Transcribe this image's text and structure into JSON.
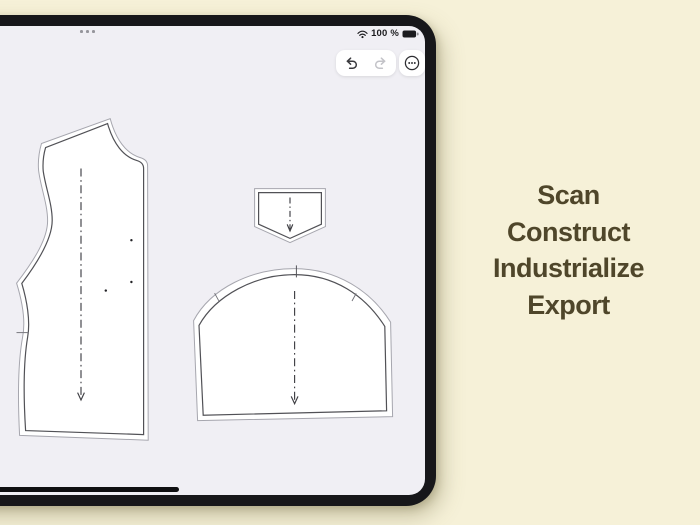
{
  "page": {
    "background_color": "#f6f1d8"
  },
  "headline": {
    "lines": [
      "Scan",
      "Construct",
      "Industrialize",
      "Export"
    ],
    "text_color": "#4f462a"
  },
  "device": {
    "frame_color": "#17171a",
    "screen_color": "#f0eff4",
    "multitask_handle": {
      "icon": "multitask-dots-icon"
    },
    "status_bar": {
      "wifi_icon": "wifi-icon",
      "battery_text": "100 %",
      "battery_icon": "battery-full-icon"
    },
    "toolbar": {
      "undo_icon": "undo-arrow-icon",
      "undo_enabled": true,
      "redo_icon": "redo-arrow-icon",
      "redo_enabled": false,
      "more_icon": "ellipsis-circle-icon"
    },
    "home_indicator": true
  },
  "canvas": {
    "pieces": [
      {
        "name": "bodice-pattern-piece",
        "markings": [
          "grainline-arrow",
          "dart-point-dots",
          "waist-notch"
        ]
      },
      {
        "name": "pocket-pattern-piece",
        "markings": [
          "grainline-arrow"
        ]
      },
      {
        "name": "sleeve-pattern-piece",
        "markings": [
          "grainline-arrow",
          "cap-notch",
          "side-notches"
        ]
      }
    ],
    "piece_fill": "#ffffff",
    "cut_line_color": "#515156",
    "seam_allowance_color": "#a6a6ae",
    "grainline_color": "#3f3f44"
  }
}
